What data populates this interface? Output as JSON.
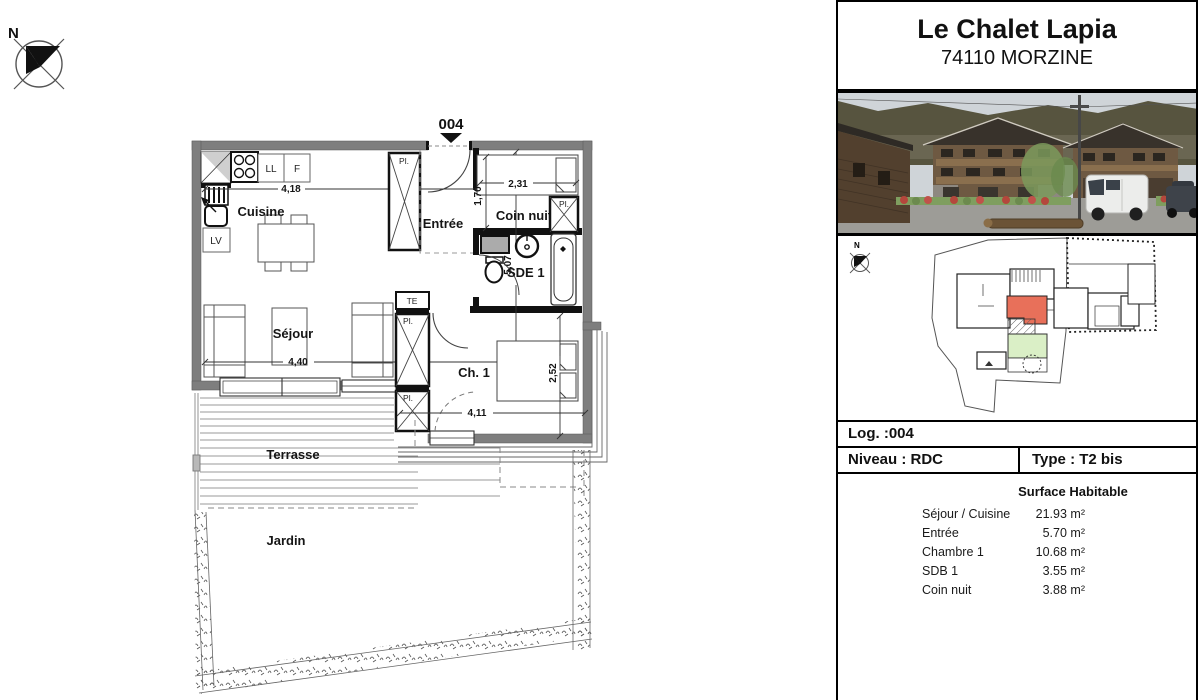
{
  "plan": {
    "compass_n": "N",
    "unit_marker": "004",
    "rooms": {
      "cuisine": "Cuisine",
      "entree": "Entrée",
      "coin_nuit": "Coin nuit",
      "sde": "SDE 1",
      "sejour": "Séjour",
      "chambre": "Ch. 1",
      "terrasse": "Terrasse",
      "jardin": "Jardin"
    },
    "fixtures": {
      "ll": "LL",
      "f": "F",
      "lv": "LV",
      "te": "TE",
      "pl": "Pl."
    },
    "dims": {
      "d418": "4,18",
      "d507": "5,07",
      "d231": "2,31",
      "d170": "1,70",
      "d440": "4,40",
      "d411": "4,11",
      "d252": "2,52"
    }
  },
  "panel": {
    "title": "Le Chalet Lapia",
    "subtitle": "74110 MORZINE",
    "siteplan_compass_n": "N",
    "log": "Log. :004",
    "niveau": "Niveau : RDC",
    "type": "Type : T2 bis",
    "surface_header": "Surface Habitable",
    "surfaces": [
      {
        "label": "Séjour / Cuisine",
        "value": "21.93 m²"
      },
      {
        "label": "Entrée",
        "value": "5.70 m²"
      },
      {
        "label": "Chambre 1",
        "value": "10.68 m²"
      },
      {
        "label": "SDB 1",
        "value": "3.55 m²"
      },
      {
        "label": "Coin nuit",
        "value": "3.88 m²"
      }
    ]
  },
  "colors": {
    "unit_highlight": "#e8705a",
    "garden_green": "#daefc6",
    "wall_gray": "#7e7e7e"
  }
}
